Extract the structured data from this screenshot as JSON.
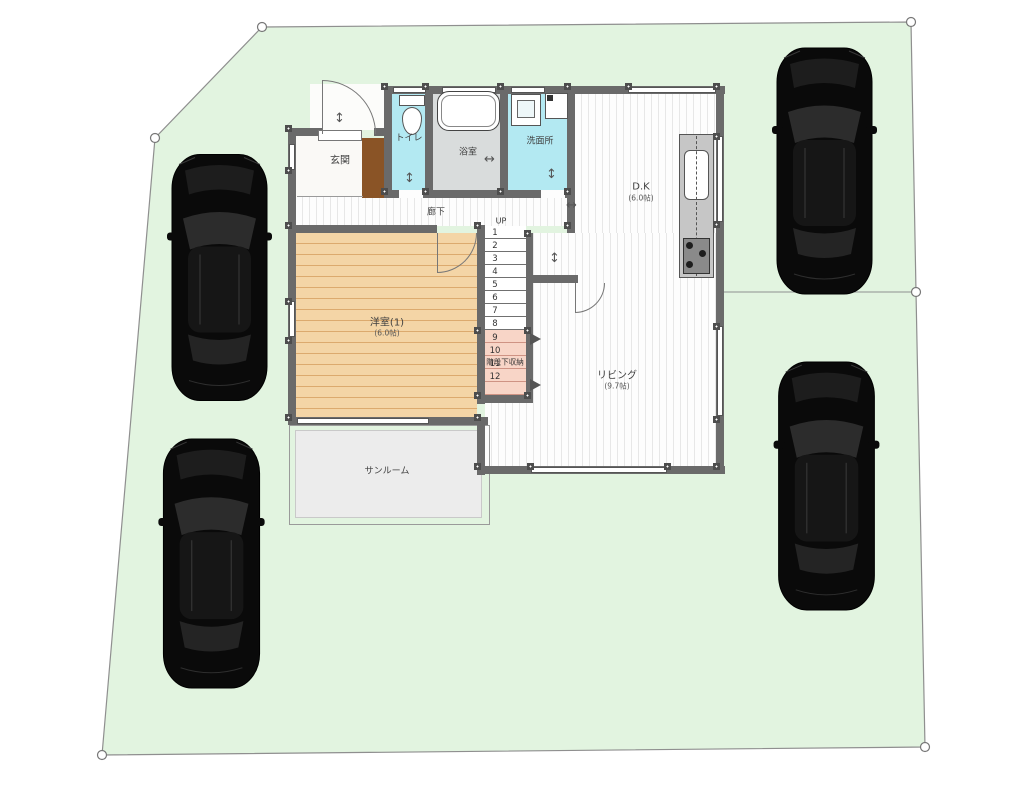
{
  "title": "1F site and floor plan",
  "floorplan": {
    "rooms": {
      "genkan": {
        "label": "玄関"
      },
      "toilet": {
        "label": "トイレ"
      },
      "bath": {
        "label": "浴室"
      },
      "washroom": {
        "label": "洗面所"
      },
      "dk": {
        "label": "D.K",
        "size": "(6.0帖)"
      },
      "hallway": {
        "label": "廊下"
      },
      "western_room": {
        "label": "洋室(1)",
        "size": "(6.0帖)"
      },
      "living": {
        "label": "リビング",
        "size": "(9.7帖)"
      },
      "sunroom": {
        "label": "サンルーム"
      },
      "stair_storage": {
        "label": "階段下収納"
      }
    },
    "stairs": {
      "up": "UP",
      "treads": [
        "1",
        "2",
        "3",
        "4",
        "5",
        "6",
        "7",
        "8"
      ],
      "hidden_treads": [
        "9",
        "10",
        "11",
        "12"
      ]
    }
  },
  "colors": {
    "site_green": "#e2f4e0",
    "boundary_gray": "#8f8f8f",
    "wall_gray": "#6a6a6a",
    "water_room_cyan": "#b3e9f2",
    "wood_floor_tan": "#f4d5a6",
    "storage_pink": "#f8d5c7",
    "car_black": "#0a0a0a"
  }
}
